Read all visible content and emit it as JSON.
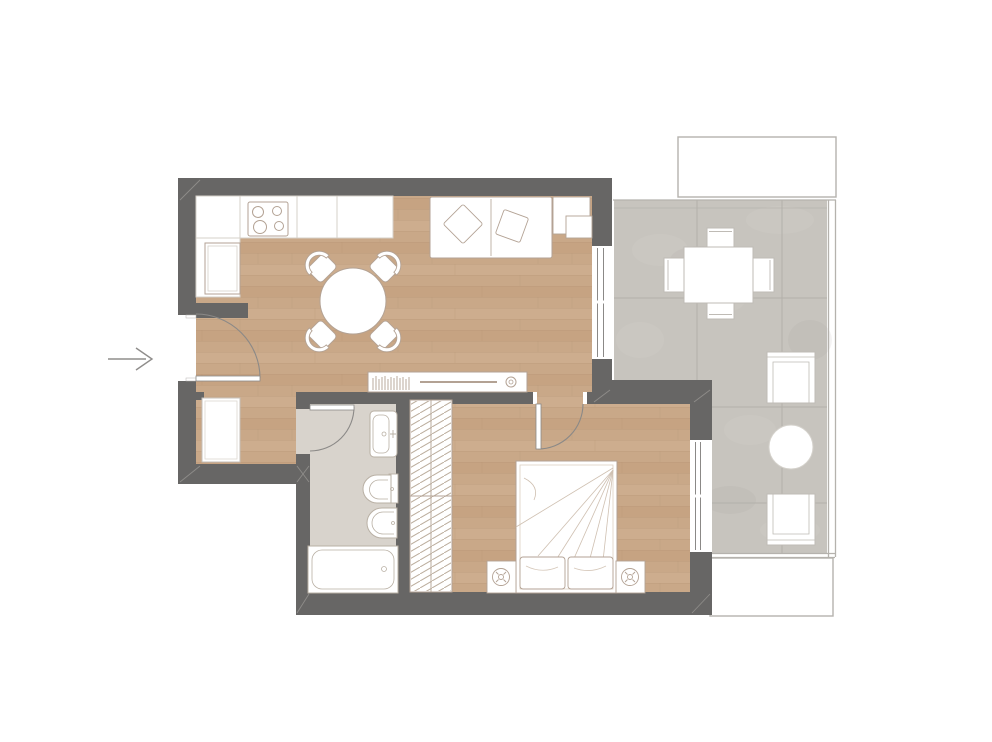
{
  "document": {
    "type": "architectural-floor-plan",
    "label": "One-bedroom apartment floor plan with terrace"
  },
  "colors": {
    "wall": "#676665",
    "wood": "#c9a888",
    "woodDark": "#c09c79",
    "woodLight": "#d2b394",
    "woodLine": "#b2906f",
    "bathFloor": "#d8d3cc",
    "tile": "#c7c4be",
    "tileJoint": "#b3b0aa",
    "tileLight": "#cfccc6",
    "furn": "#b3a294",
    "furnGray": "#bfbbb5",
    "fixture": "#b9b0a4",
    "counterLine": "#d6d0c9",
    "arc": "#8b8987",
    "railing": "#b5b2ad",
    "arrow": "#8f8d8b",
    "hatch": "#bcae9e",
    "white": "#ffffff",
    "canvas": "#ffffff"
  },
  "entry": {
    "label": "entry",
    "direction": "right",
    "glyph": "→"
  },
  "rooms": [
    {
      "id": "kitchen",
      "floor": "wood",
      "items": [
        "kitchen-counter-l-shape",
        "cooktop-four-burners",
        "tall-cabinet-fridge"
      ]
    },
    {
      "id": "living-dining",
      "floor": "wood",
      "items": [
        "round-dining-table",
        "four-dining-chairs",
        "two-seat-sofa",
        "two-cushions",
        "two-side-tables",
        "tv-sideboard",
        "books-row",
        "speaker-disc"
      ]
    },
    {
      "id": "hallway",
      "floor": "wood",
      "items": [
        "entry-door-swing",
        "hall-closet"
      ]
    },
    {
      "id": "bathroom",
      "floor": "ceramic",
      "items": [
        "washbasin",
        "toilet",
        "bidet",
        "bathtub",
        "bathroom-door-swing"
      ]
    },
    {
      "id": "bedroom",
      "floor": "wood",
      "items": [
        "double-bed",
        "two-pillows",
        "nightstand-left",
        "nightstand-right",
        "two-table-lamps",
        "hatched-wardrobe",
        "bedroom-door-swing",
        "window-to-terrace"
      ]
    },
    {
      "id": "terrace",
      "floor": "stone-tile",
      "items": [
        "outdoor-dining-table",
        "four-outdoor-chairs",
        "lounge-chair-upper",
        "round-side-table",
        "lounge-chair-lower",
        "balcony-railing",
        "awning-outline-top",
        "awning-outline-bottom",
        "sliding-glass-door"
      ]
    }
  ]
}
